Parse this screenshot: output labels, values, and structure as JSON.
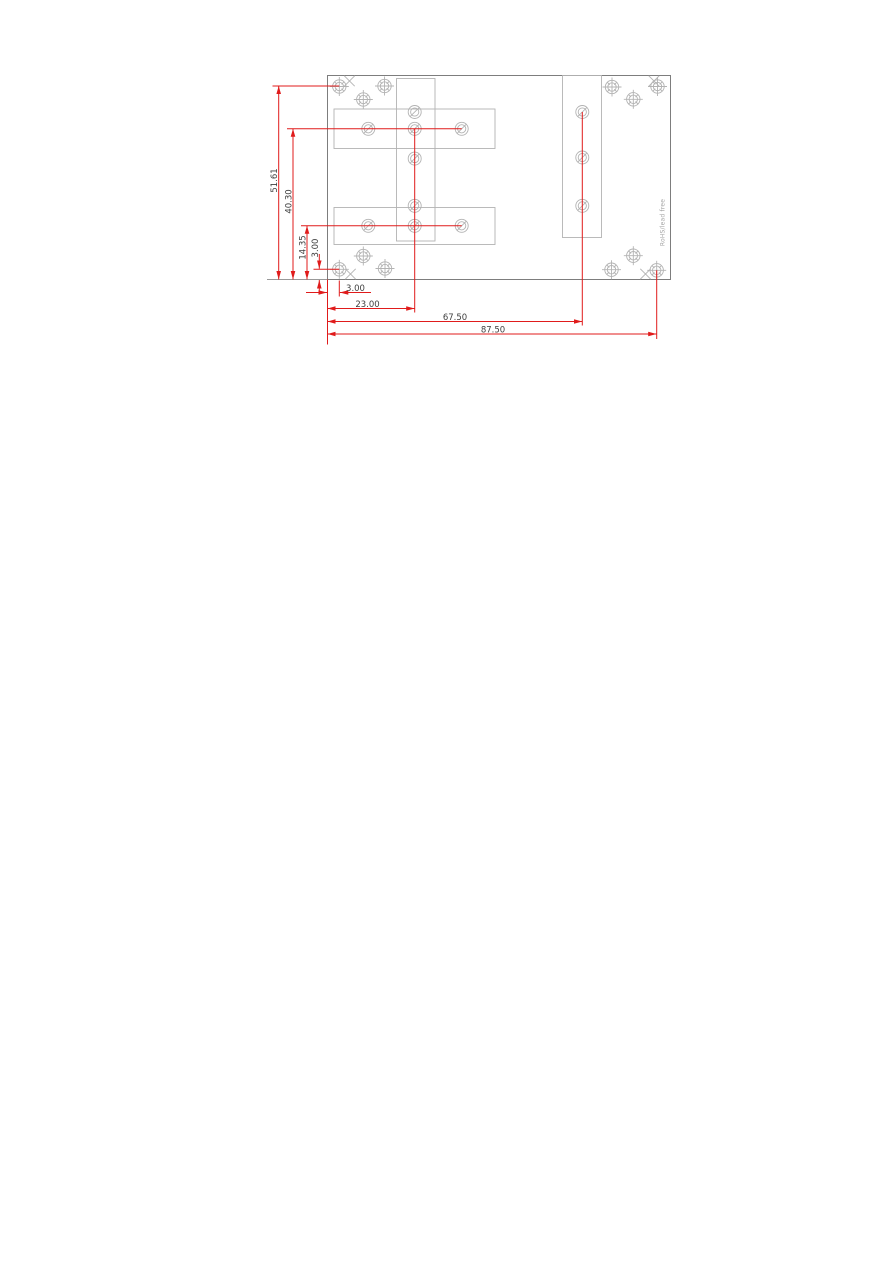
{
  "page": {
    "width_px": 893,
    "height_px": 1263,
    "background": "#ffffff"
  },
  "drawing": {
    "kind": "mechanical-dimension-drawing",
    "note": {
      "text": "RoHS/lead free"
    },
    "colors": {
      "dimension_red": "#e01b1b",
      "board_outline": "#7d7d7d",
      "feature_gray": "#b3b3b3",
      "label_gray": "#3f3f3f",
      "note_gray": "#a3a3a3"
    },
    "vertical_dimensions": [
      {
        "label": "51.61"
      },
      {
        "label": "40.30"
      },
      {
        "label": "14.35"
      },
      {
        "label": "3.00"
      }
    ],
    "horizontal_dimensions": [
      {
        "label": "3.00"
      },
      {
        "label": "23.00"
      },
      {
        "label": "67.50"
      },
      {
        "label": "87.50"
      }
    ]
  }
}
